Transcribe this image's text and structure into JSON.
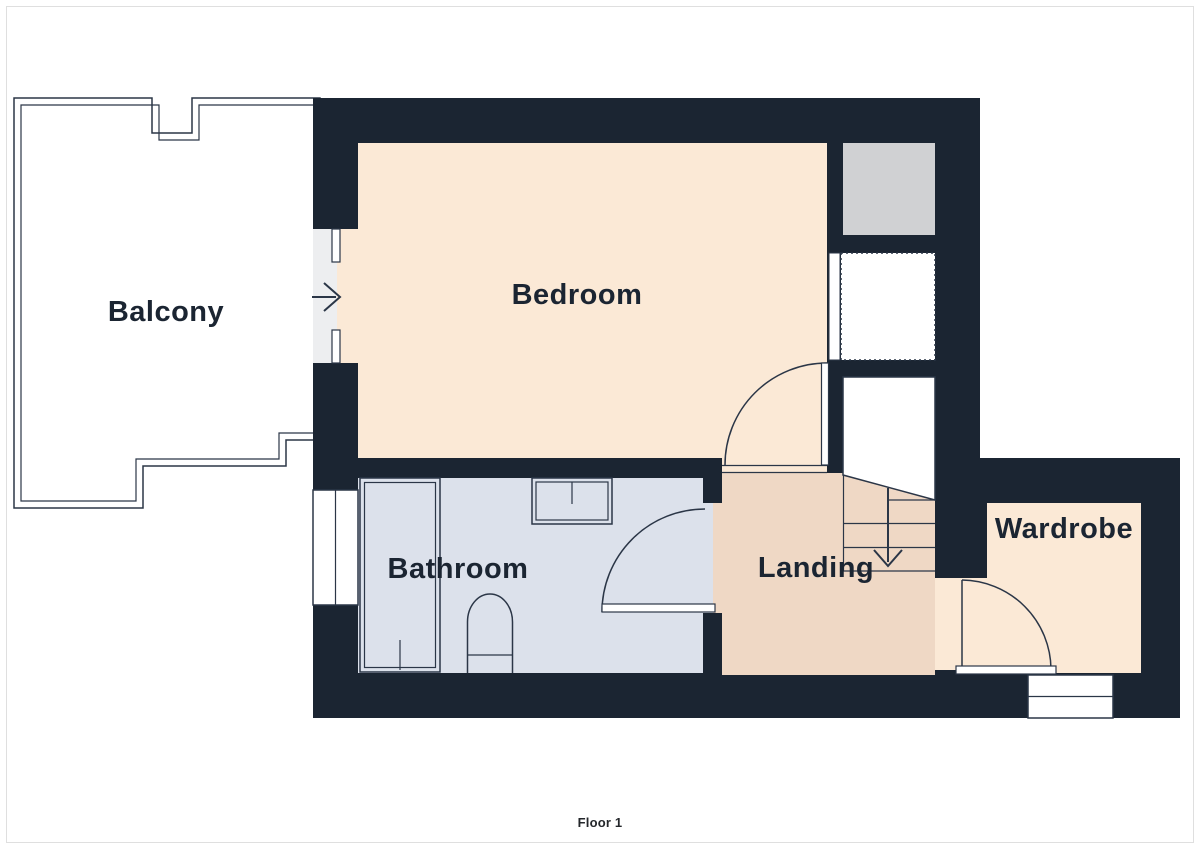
{
  "floorplan": {
    "caption": "Floor 1",
    "rooms": {
      "balcony": {
        "label": "Balcony"
      },
      "bedroom": {
        "label": "Bedroom"
      },
      "bathroom": {
        "label": "Bathroom"
      },
      "landing": {
        "label": "Landing"
      },
      "wardrobe": {
        "label": "Wardrobe"
      }
    },
    "icons": {
      "balcony_entry": "right-arrow",
      "stairs_flow": "down-arrow"
    },
    "colors": {
      "wall": "#1B2532",
      "room_light": "#FBE9D6",
      "landing": "#EFD8C5",
      "bathroom": "#DCE1EB",
      "balcony": "#EDEEF0",
      "shaft": "#D0D1D3",
      "line": "#2B3647",
      "label_text": "#1B2532",
      "frame": "#DFDFDF",
      "background": "#FFFFFF"
    }
  }
}
